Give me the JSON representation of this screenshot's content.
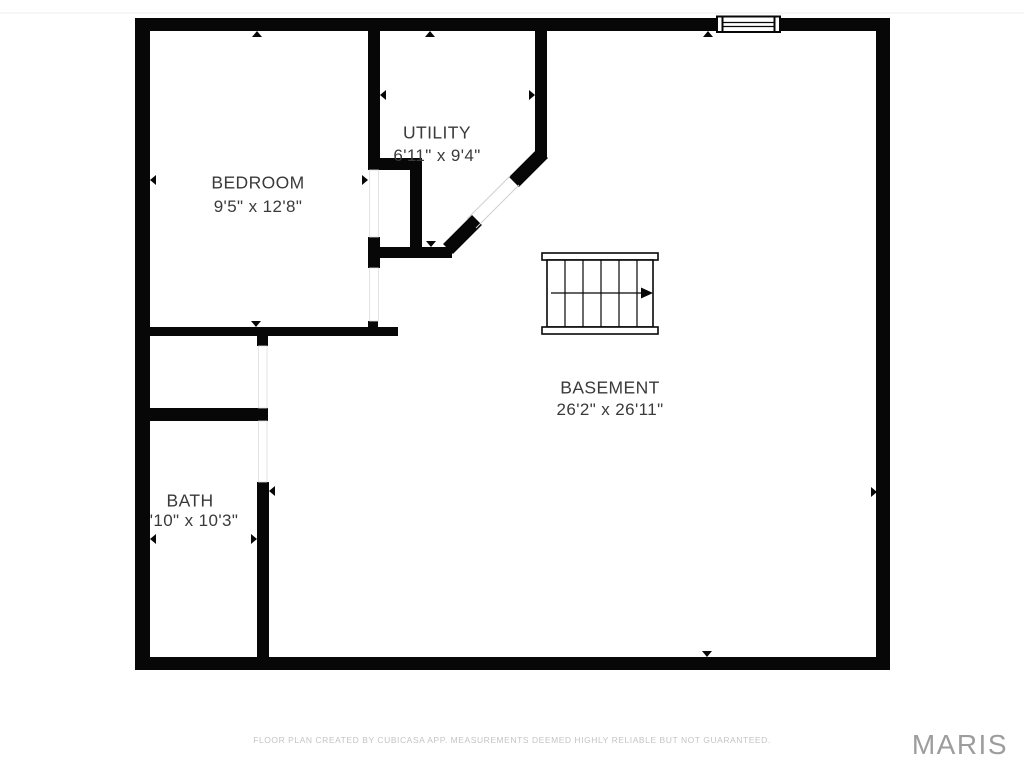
{
  "plan": {
    "type": "floor-plan",
    "floor_name": "Basement level"
  },
  "rooms": [
    {
      "id": "bedroom",
      "name": "BEDROOM",
      "dimensions": "9'5\" x 12'8\""
    },
    {
      "id": "utility",
      "name": "UTILITY",
      "dimensions": "6'11\" x 9'4\""
    },
    {
      "id": "basement",
      "name": "BASEMENT",
      "dimensions": "26'2\" x 26'11\""
    },
    {
      "id": "bath",
      "name": "BATH",
      "dimensions": "'10\" x 10'3\""
    }
  ],
  "stairs": {
    "treads": 6,
    "direction_arrow": "right"
  },
  "features": {
    "window_top_wall": 1,
    "door_openings": 5,
    "dimension_markers": 14
  },
  "footer": {
    "disclaimer": "FLOOR PLAN CREATED BY CUBICASA APP. MEASUREMENTS DEEMED HIGHLY RELIABLE BUT NOT GUARANTEED."
  },
  "watermark": {
    "text": "MARIS"
  },
  "colors": {
    "wall": "#070707",
    "label_text": "#3a3a3a",
    "footer_text": "#c4c4c4",
    "watermark_text": "#9d9d9d",
    "door_line": "#d0d0d0",
    "background": "#ffffff"
  }
}
